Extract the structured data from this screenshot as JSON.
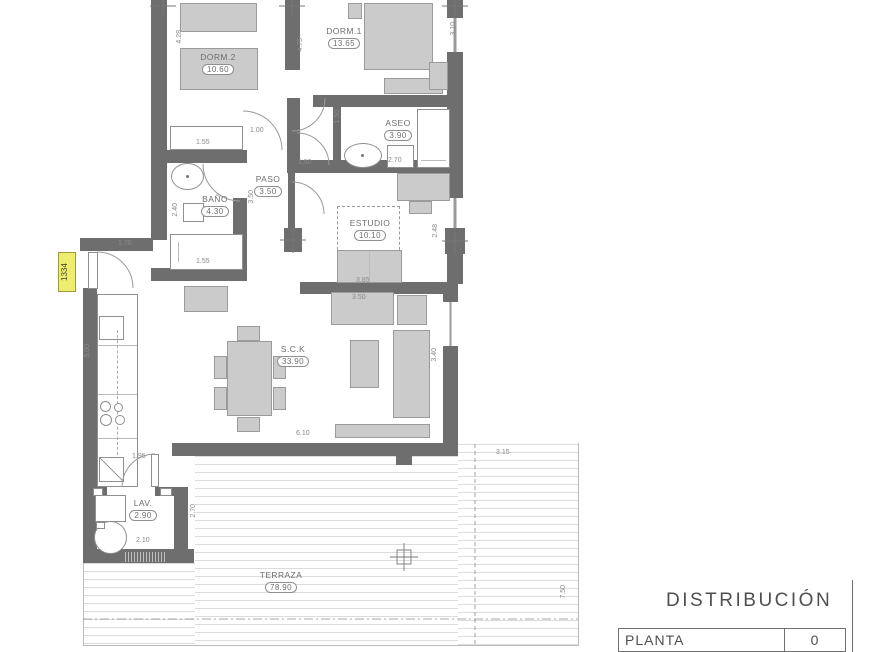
{
  "plan": {
    "entry_tag": "1334",
    "rooms": [
      {
        "name": "DORM.2",
        "area": "10.60"
      },
      {
        "name": "DORM.1",
        "area": "13.65"
      },
      {
        "name": "ASEO",
        "area": "3.90"
      },
      {
        "name": "BAÑO",
        "area": "4.30"
      },
      {
        "name": "PASO",
        "area": "3.50"
      },
      {
        "name": "ESTUDIO",
        "area": "10.10"
      },
      {
        "name": "S.C.K",
        "area": "33.90"
      },
      {
        "name": "LAV.",
        "area": "2.90"
      },
      {
        "name": "TERRAZA",
        "area": "78.90"
      }
    ],
    "dims": [
      "4.28",
      "1.55",
      "1.00",
      "4.75",
      "3.10",
      "1.50",
      "2.70",
      "2.40",
      "1.55",
      "3.50",
      "1.50",
      "2.48",
      "3.85",
      "3.50",
      "3.40",
      "6.10",
      "1.70",
      "5.00",
      "1.95",
      "2.10",
      "2.70",
      "3.15",
      "7.50"
    ]
  },
  "title_block": {
    "title": "DISTRIBUCIÓN",
    "rows": [
      {
        "label": "PLANTA",
        "value": "0"
      }
    ]
  },
  "colors": {
    "wall": "#6e6e6e",
    "furniture": "#cbcbcb",
    "tag_bg": "#efed6d"
  }
}
